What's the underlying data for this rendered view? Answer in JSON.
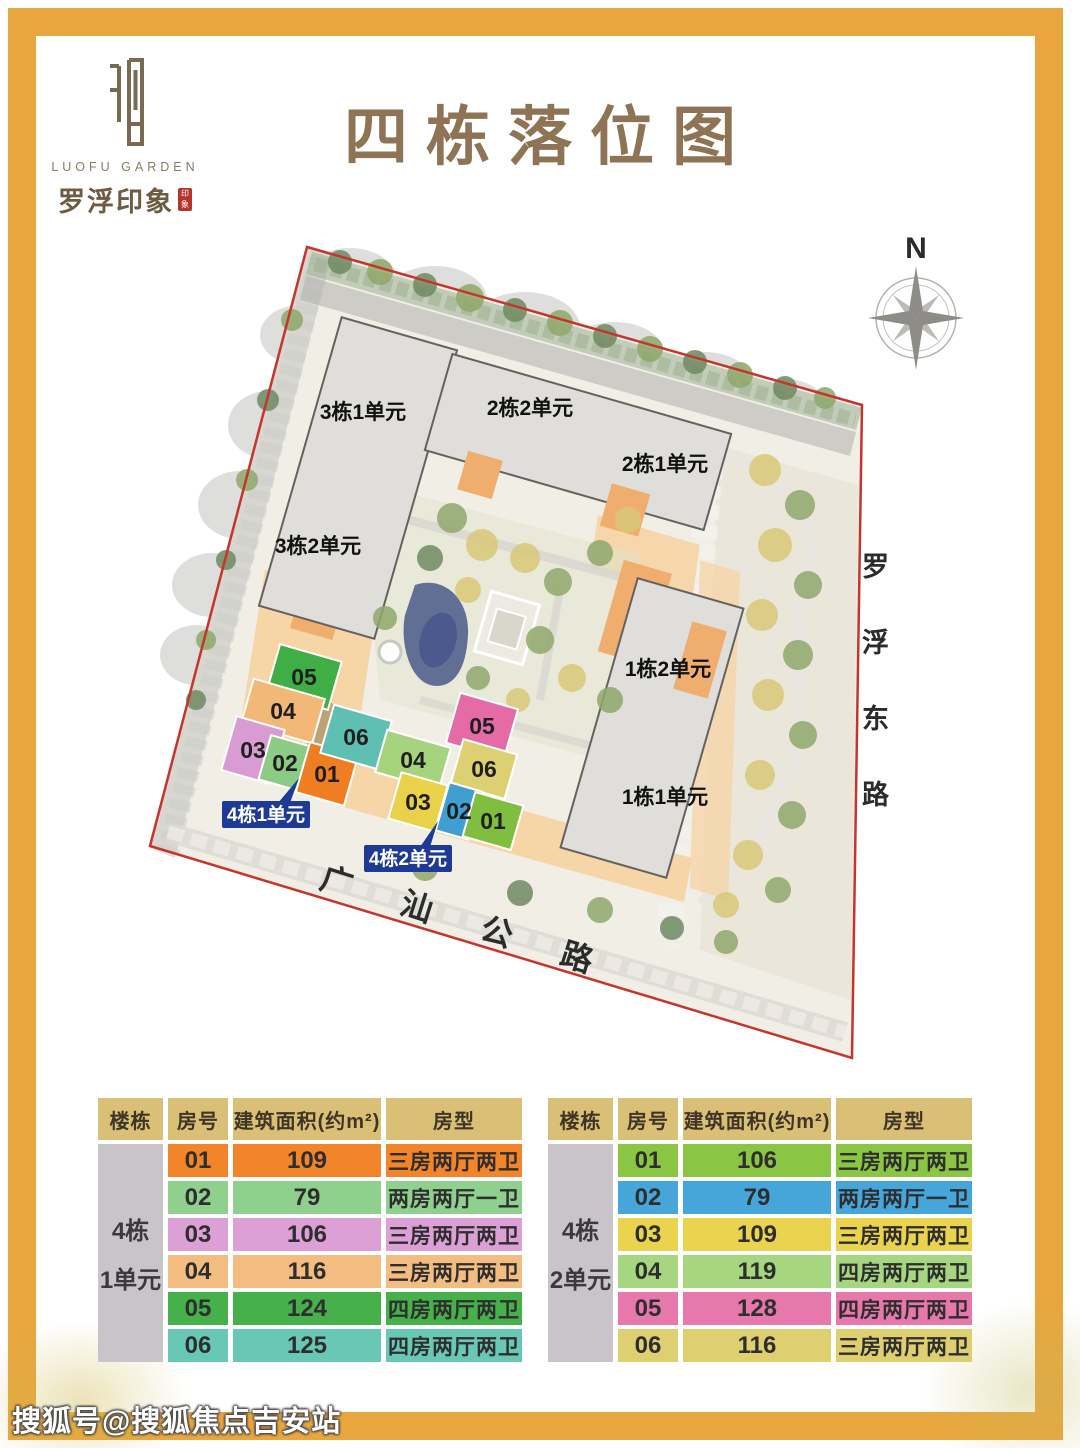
{
  "page": {
    "title": "四栋落位图",
    "watermark": "搜狐号@搜狐焦点吉安站",
    "border_color": "#E9A63E",
    "title_color": "#8F7355"
  },
  "logo": {
    "name_en": "LUOFU GARDEN",
    "name_cn": "罗浮印象",
    "seal_icon": "yin-seal-icon",
    "stamp_color": "#B5342C"
  },
  "map": {
    "compass_label": "N",
    "boundary_color": "#C5352C",
    "roads": {
      "east": "罗浮东路",
      "south": "广汕公路"
    },
    "buildings": [
      {
        "label": "3栋1单元"
      },
      {
        "label": "3栋2单元"
      },
      {
        "label": "2栋2单元"
      },
      {
        "label": "2栋1单元"
      },
      {
        "label": "1栋2单元"
      },
      {
        "label": "1栋1单元"
      }
    ],
    "callouts": [
      {
        "label": "4栋1单元",
        "color": "#1E3A96"
      },
      {
        "label": "4栋2单元",
        "color": "#1E3A96"
      }
    ],
    "unit1_blocks": [
      {
        "id": "05",
        "color": "#3FAE44"
      },
      {
        "id": "04",
        "color": "#F2B878"
      },
      {
        "id": "03",
        "color": "#D89BD2"
      },
      {
        "id": "02",
        "color": "#8CCB86"
      },
      {
        "id": "01",
        "color": "#EF7E22"
      },
      {
        "id": "06",
        "color": "#5FBFB2"
      }
    ],
    "unit2_blocks": [
      {
        "id": "05",
        "color": "#E46BA6"
      },
      {
        "id": "06",
        "color": "#DCD072"
      },
      {
        "id": "04",
        "color": "#A6D47E"
      },
      {
        "id": "03",
        "color": "#E9D14A"
      },
      {
        "id": "02",
        "color": "#3F9FD0"
      },
      {
        "id": "01",
        "color": "#7FBE3E"
      }
    ]
  },
  "tables": [
    {
      "building": "4栋",
      "unit": "1单元",
      "headers": [
        "楼栋",
        "房号",
        "建筑面积(约m²)",
        "房型"
      ],
      "rows": [
        {
          "no": "01",
          "area": "109",
          "type": "三房两厅两卫",
          "color": "#F28429"
        },
        {
          "no": "02",
          "area": "79",
          "type": "两房两厅一卫",
          "color": "#8FD08F"
        },
        {
          "no": "03",
          "area": "106",
          "type": "三房两厅两卫",
          "color": "#DC9FD6"
        },
        {
          "no": "04",
          "area": "116",
          "type": "三房两厅两卫",
          "color": "#F3BD82"
        },
        {
          "no": "05",
          "area": "124",
          "type": "四房两厅两卫",
          "color": "#46B14B"
        },
        {
          "no": "06",
          "area": "125",
          "type": "四房两厅两卫",
          "color": "#69C7B5"
        }
      ]
    },
    {
      "building": "4栋",
      "unit": "2单元",
      "headers": [
        "楼栋",
        "房号",
        "建筑面积(约m²)",
        "房型"
      ],
      "rows": [
        {
          "no": "01",
          "area": "106",
          "type": "三房两厅两卫",
          "color": "#8AC643"
        },
        {
          "no": "02",
          "area": "79",
          "type": "两房两厅一卫",
          "color": "#46A5D9"
        },
        {
          "no": "03",
          "area": "109",
          "type": "三房两厅两卫",
          "color": "#EAD34E"
        },
        {
          "no": "04",
          "area": "119",
          "type": "四房两厅两卫",
          "color": "#A6D680"
        },
        {
          "no": "05",
          "area": "128",
          "type": "四房两厅两卫",
          "color": "#E778AB"
        },
        {
          "no": "06",
          "area": "116",
          "type": "三房两厅两卫",
          "color": "#DECF70"
        }
      ]
    }
  ]
}
